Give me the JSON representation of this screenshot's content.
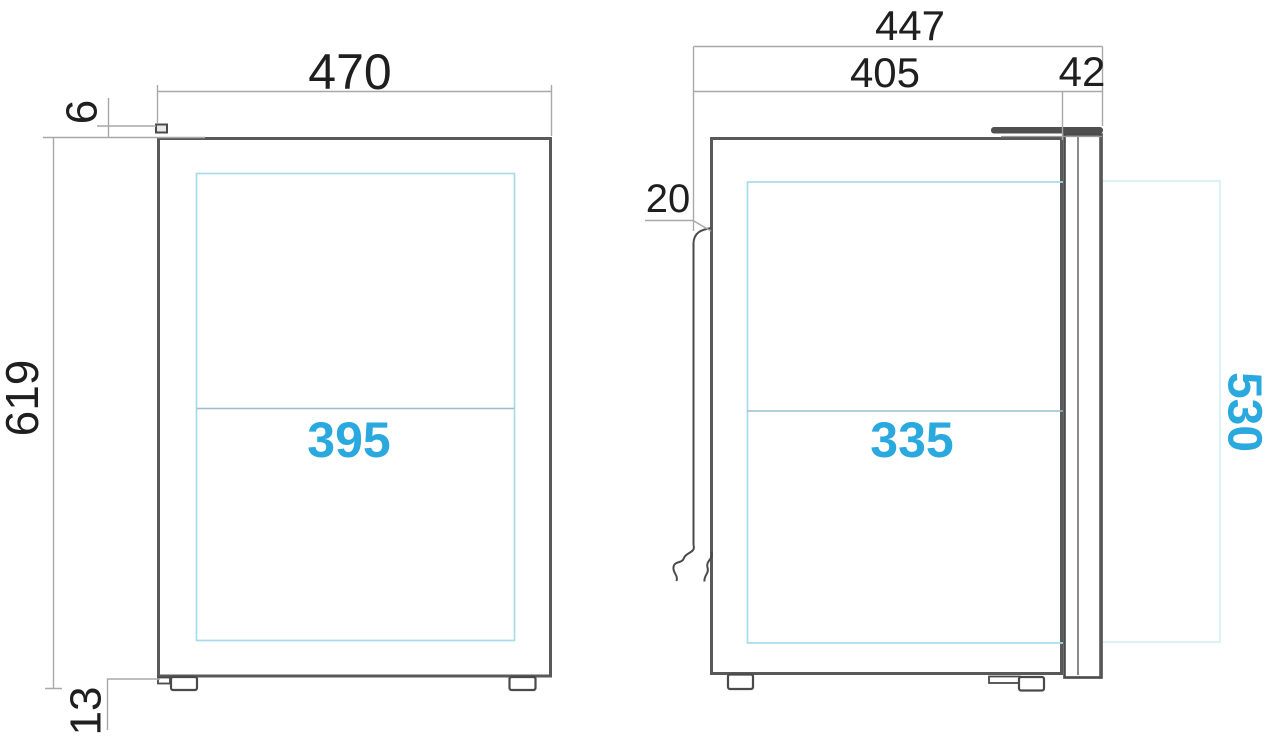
{
  "labels": {
    "front_width": "470",
    "front_pin_height": "6",
    "front_total_height": "619",
    "front_foot_height": "13",
    "front_glass_width": "395",
    "side_total_depth": "447",
    "side_body_depth": "405",
    "side_door_thickness": "42",
    "side_back_clearance": "20",
    "side_glass_depth": "335",
    "side_glass_height": "530"
  },
  "colors": {
    "accent": "#2aa9df",
    "glass": "#a9dbe9",
    "faint": "#d5edf6",
    "midline": "#9cbecd",
    "outline": "#595959",
    "dark": "#4a4a4a",
    "dim": "#a8a8a8",
    "text": "#1f1f1f",
    "bg": "#ffffff"
  }
}
